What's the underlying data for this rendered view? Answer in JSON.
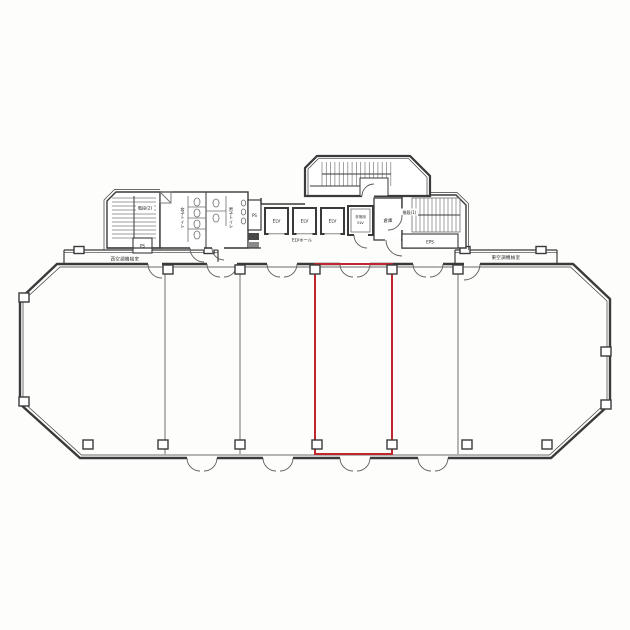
{
  "plan": {
    "labels": {
      "west_ac_room": "西空調機械室",
      "east_ac_room": "東空調機械室",
      "elv_hall": "ELVホール",
      "elevator": "ELV",
      "emergency_elevator_top": "非常用",
      "emergency_elevator_bottom": "ELV",
      "storage_room": "倉庫",
      "stairs_1": "階段(1)",
      "stairs_2": "階段(2)",
      "eps": "EPS",
      "ps": "PS",
      "womens_toilet": "女子トイレ",
      "mens_toilet": "男子トイレ"
    },
    "colors": {
      "highlight_red": "#c0272d",
      "line": "#3a3a3a"
    }
  }
}
